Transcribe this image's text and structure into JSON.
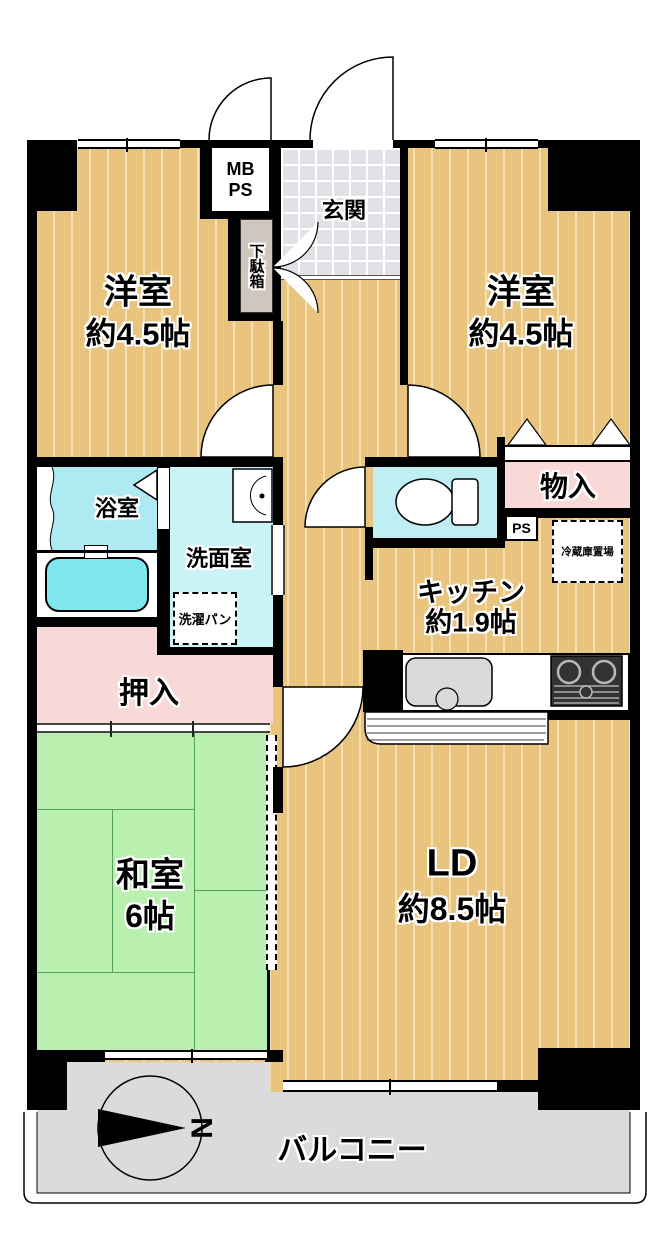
{
  "colors": {
    "wall": "#000000",
    "flooring": "#e8c47e",
    "flooring-stripe": "#f4dfae",
    "tatami": "#b9f0b0",
    "tatami-line": "#55a15c",
    "tile": "#e2e2e6",
    "bath": "#aeeaf2",
    "washroom": "#c9f3f7",
    "toilet-room": "#bfeff3",
    "bathtub": "#7fe8ee",
    "closet-pink": "#f9d8d8",
    "balcony": "#dbdbdd",
    "shoebox": "#cfc6bd",
    "stove": "#333333"
  },
  "rooms": {
    "western_left": {
      "name": "洋室",
      "size": "約4.5帖"
    },
    "western_right": {
      "name": "洋室",
      "size": "約4.5帖"
    },
    "entrance": {
      "name": "玄関"
    },
    "meter_box": {
      "line1": "MB",
      "line2": "PS"
    },
    "shoe_box": {
      "name": "下駄箱"
    },
    "bathroom": {
      "name": "浴室"
    },
    "washroom": {
      "name": "洗面室"
    },
    "laundry_pan": {
      "name": "洗濯パン"
    },
    "storage": {
      "name": "物入"
    },
    "pipe_space": {
      "name": "PS"
    },
    "fridge_space": {
      "name": "冷蔵庫置場"
    },
    "kitchen": {
      "name": "キッチン",
      "size": "約1.9帖"
    },
    "closet": {
      "name": "押入"
    },
    "japanese_room": {
      "name": "和室",
      "size": "6帖"
    },
    "living_dining": {
      "name": "LD",
      "size": "約8.5帖"
    },
    "balcony": {
      "name": "バルコニー"
    }
  },
  "compass": {
    "label": "N"
  }
}
